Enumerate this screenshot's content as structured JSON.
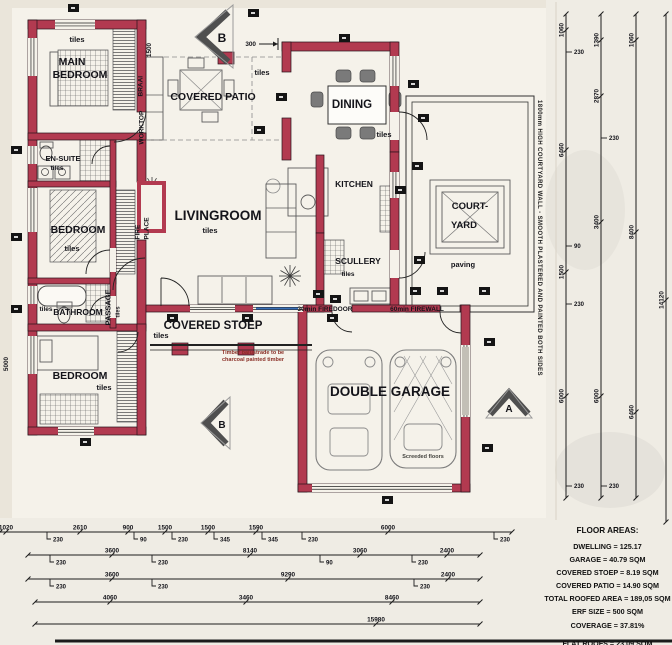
{
  "labels": {
    "main_bedroom_line1": "MAIN",
    "main_bedroom_line2": "BEDROOM",
    "tiles": "tiles",
    "en_suite": "EN-SUITE",
    "bedroom_mid": "BEDROOM",
    "bathroom": "BATHROOM",
    "bedroom_bottom": "BEDROOM",
    "passage": "PASSAGE",
    "fire": "FIRE",
    "place": "PLACE",
    "braai": "BRAAI",
    "worktop": "WORKTOP",
    "covered_patio": "COVERED PATIO",
    "livingroom": "LIVINGROOM",
    "dining": "DINING",
    "kitchen": "KITCHEN",
    "scullery": "SCULLERY",
    "courtyard_line1": "COURT-",
    "courtyard_line2": "YARD",
    "paving": "paving",
    "covered_stoep": "COVERED STOEP",
    "double_garage": "DOUBLE GARAGE",
    "firedoor_note": "30min FIREDOOR",
    "firewall_note": "60min FIREWALL",
    "timber_note_line1": "Timber balustrade to be",
    "timber_note_line2": "charcoal painted timber",
    "garage_floor_note": "Screeded floors",
    "courtyard_wall_note": "1800mm HIGH COURTYARD WALL - SMOOTH PLASTERED AND PAINTED BOTH SIDES",
    "section_a": "A",
    "section_b": "B"
  },
  "floor_areas": {
    "title": "FLOOR AREAS:",
    "rows": [
      "DWELLING = 125.17",
      "GARAGE = 40.79 SQM",
      "COVERED STOEP = 8.19 SQM",
      "COVERED PATIO = 14.90 SQM",
      "TOTAL ROOFED AREA = 189,05 SQM",
      "ERF SIZE = 500 SQM",
      "COVERAGE = 37.81%"
    ],
    "flat_roofs": "FLAT ROOFS = 23.09 SQM"
  },
  "colors": {
    "wall": "#b23a50",
    "paper": "#ece8df",
    "line": "#1c1c1c",
    "glass": "#3a6fb5"
  },
  "dimensions": {
    "bottom_rows": [
      {
        "y": 532,
        "x1": 0,
        "x2": 512,
        "labels": [
          {
            "x": 6,
            "t": "1020"
          },
          {
            "x": 47,
            "t": "230",
            "b": 1
          },
          {
            "x": 80,
            "t": "2610"
          },
          {
            "x": 128,
            "t": "900"
          },
          {
            "x": 134,
            "t": "90",
            "b": 1
          },
          {
            "x": 165,
            "t": "1500"
          },
          {
            "x": 172,
            "t": "230",
            "b": 1
          },
          {
            "x": 208,
            "t": "1500"
          },
          {
            "x": 214,
            "t": "345",
            "b": 1
          },
          {
            "x": 256,
            "t": "1590"
          },
          {
            "x": 262,
            "t": "345",
            "b": 1
          },
          {
            "x": 302,
            "t": "230",
            "b": 1
          },
          {
            "x": 388,
            "t": "6000"
          },
          {
            "x": 494,
            "t": "230",
            "b": 1
          }
        ]
      },
      {
        "y": 555,
        "x1": 28,
        "x2": 480,
        "labels": [
          {
            "x": 50,
            "t": "230",
            "b": 1
          },
          {
            "x": 112,
            "t": "3600"
          },
          {
            "x": 152,
            "t": "230",
            "b": 1
          },
          {
            "x": 250,
            "t": "8140"
          },
          {
            "x": 320,
            "t": "90",
            "b": 1
          },
          {
            "x": 360,
            "t": "3060"
          },
          {
            "x": 412,
            "t": "230",
            "b": 1
          },
          {
            "x": 447,
            "t": "2400"
          }
        ]
      },
      {
        "y": 579,
        "x1": 28,
        "x2": 480,
        "labels": [
          {
            "x": 50,
            "t": "230",
            "b": 1
          },
          {
            "x": 112,
            "t": "3600"
          },
          {
            "x": 152,
            "t": "230",
            "b": 1
          },
          {
            "x": 288,
            "t": "9290"
          },
          {
            "x": 414,
            "t": "230",
            "b": 1
          },
          {
            "x": 448,
            "t": "2400"
          }
        ]
      },
      {
        "y": 602,
        "x1": 35,
        "x2": 480,
        "labels": [
          {
            "x": 110,
            "t": "4060"
          },
          {
            "x": 246,
            "t": "3460"
          },
          {
            "x": 392,
            "t": "8460"
          }
        ]
      },
      {
        "y": 624,
        "x1": 35,
        "x2": 480,
        "labels": [
          {
            "x": 376,
            "t": "15980"
          }
        ]
      }
    ],
    "right_cols": [
      {
        "x": 566,
        "y1": 14,
        "y2": 498,
        "labels": [
          {
            "y": 30,
            "t": "1060"
          },
          {
            "y": 52,
            "t": "230",
            "b": 1
          },
          {
            "y": 150,
            "t": "6460"
          },
          {
            "y": 246,
            "t": "90",
            "b": 1
          },
          {
            "y": 272,
            "t": "1500"
          },
          {
            "y": 304,
            "t": "230",
            "b": 1
          },
          {
            "y": 396,
            "t": "6000"
          },
          {
            "y": 486,
            "t": "230",
            "b": 1
          }
        ]
      },
      {
        "x": 601,
        "y1": 14,
        "y2": 498,
        "labels": [
          {
            "y": 40,
            "t": "1390"
          },
          {
            "y": 96,
            "t": "2870"
          },
          {
            "y": 138,
            "t": "230",
            "b": 1
          },
          {
            "y": 222,
            "t": "3400"
          },
          {
            "y": 396,
            "t": "6000"
          },
          {
            "y": 486,
            "t": "230",
            "b": 1
          }
        ]
      },
      {
        "x": 636,
        "y1": 14,
        "y2": 498,
        "labels": [
          {
            "y": 40,
            "t": "1060"
          },
          {
            "y": 232,
            "t": "8400"
          },
          {
            "y": 412,
            "t": "6460"
          }
        ]
      },
      {
        "x": 666,
        "y1": 14,
        "y2": 522,
        "labels": [
          {
            "y": 300,
            "t": "14120"
          }
        ]
      }
    ],
    "misc": [
      {
        "x": 256,
        "y": 44,
        "t": "300",
        "arrow": 1
      },
      {
        "x": 148,
        "y": 50,
        "t": "1500",
        "rot": 1
      },
      {
        "x": 5,
        "y": 364,
        "t": "5000",
        "rot": 1
      }
    ]
  }
}
